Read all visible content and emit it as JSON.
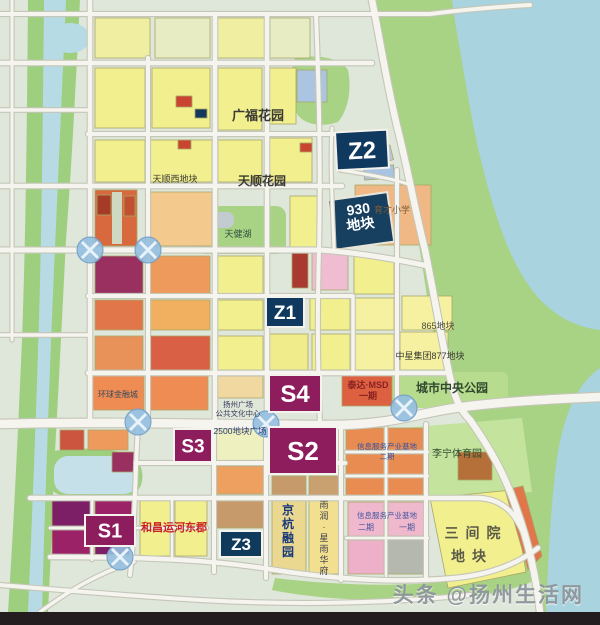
{
  "map": {
    "title": "城市地块规划图",
    "watermark": "头条 @扬州生活网",
    "colors": {
      "water": "#a9d3de",
      "river": "#b7dbe4",
      "green": "#a8d284",
      "park_light": "#c4e49e",
      "yellow_parcel": "#f2ef8f",
      "orange_parcel": "#ee9a5c",
      "red_parcel": "#d95f45",
      "pink_parcel": "#f0bcd2",
      "maroon_zone": "#8e1d5e",
      "navy_zone": "#10395f",
      "tan_parcel": "#c79a6b",
      "road": "#f6f4ee",
      "label_red": "#cc2222"
    },
    "zone_badges": [
      {
        "id": "Z2",
        "label": "Z2",
        "x": 336,
        "y": 131,
        "w": 52,
        "h": 38,
        "bg": "#10395f",
        "size": 24,
        "rotate": -3
      },
      {
        "id": "Z1",
        "label": "Z1",
        "x": 266,
        "y": 297,
        "w": 38,
        "h": 30,
        "bg": "#10395f",
        "size": 19
      },
      {
        "id": "Z3",
        "label": "Z3",
        "x": 220,
        "y": 531,
        "w": 42,
        "h": 26,
        "bg": "#0f3a5c",
        "size": 17
      },
      {
        "id": "S4",
        "label": "S4",
        "x": 269,
        "y": 375,
        "w": 52,
        "h": 37,
        "bg": "#8e1d5e",
        "size": 24
      },
      {
        "id": "S2",
        "label": "S2",
        "x": 269,
        "y": 427,
        "w": 68,
        "h": 47,
        "bg": "#8e1d5e",
        "size": 26
      },
      {
        "id": "S3",
        "label": "S3",
        "x": 174,
        "y": 429,
        "w": 38,
        "h": 33,
        "bg": "#8e1d5e",
        "size": 19
      },
      {
        "id": "S1",
        "label": "S1",
        "x": 85,
        "y": 515,
        "w": 50,
        "h": 31,
        "bg": "#8e1d5e",
        "size": 20
      }
    ],
    "region_labels": [
      {
        "text": "广福花园",
        "x": 258,
        "y": 120,
        "size": 13,
        "color": "#3a3a32",
        "weight": 700
      },
      {
        "text": "天顺西地块",
        "x": 175,
        "y": 182,
        "size": 9,
        "color": "#3a3a32"
      },
      {
        "text": "天顺花园",
        "x": 262,
        "y": 185,
        "size": 12,
        "color": "#3a3a32",
        "weight": 700
      },
      {
        "text": "天健湖",
        "x": 238,
        "y": 237,
        "size": 9,
        "color": "#2f4f3f"
      },
      {
        "text": "育才小学",
        "x": 392,
        "y": 213,
        "size": 9,
        "color": "#7a5a3a"
      },
      {
        "lines": [
          "930",
          "地块"
        ],
        "x": 359,
        "y": 214,
        "size": 14,
        "lh": 15,
        "color": "#ffffff",
        "weight": 700,
        "rotate": -8
      },
      {
        "text": "865地块",
        "x": 438,
        "y": 329,
        "size": 9,
        "color": "#4a4a3a"
      },
      {
        "text": "中星集团877地块",
        "x": 430,
        "y": 359,
        "size": 9,
        "color": "#3a3a32"
      },
      {
        "text": "城市中央公园",
        "x": 452,
        "y": 392,
        "size": 12,
        "color": "#2f4a2f",
        "weight": 700
      },
      {
        "lines": [
          "泰达·MSD",
          "一期"
        ],
        "x": 368,
        "y": 388,
        "size": 9,
        "lh": 11,
        "color": "#8a2222",
        "weight": 700
      },
      {
        "text": "李宁体育园",
        "x": 457,
        "y": 457,
        "size": 10,
        "color": "#2f4a2f"
      },
      {
        "text": "三间院",
        "x": 476,
        "y": 538,
        "size": 14,
        "color": "#5a5a48",
        "weight": 700,
        "spacing": 7
      },
      {
        "text": "地块",
        "x": 472,
        "y": 561,
        "size": 14,
        "color": "#5a5a48",
        "weight": 700,
        "spacing": 7
      },
      {
        "text": "和昌运河东郡",
        "x": 174,
        "y": 531,
        "size": 11,
        "color": "#cc2222",
        "weight": 700
      },
      {
        "text": "京杭融园",
        "x": 288,
        "y": 514,
        "size": 12,
        "color": "#1a3a7a",
        "weight": 700,
        "vertical": true
      },
      {
        "text": "雨润·星雨华府",
        "x": 324,
        "y": 508,
        "size": 9,
        "color": "#3a3a4a",
        "vertical": true
      },
      {
        "text": "信息服务产业基地",
        "x": 387,
        "y": 518,
        "size": 7.5,
        "color": "#4455a0"
      },
      {
        "text": "二期",
        "x": 366,
        "y": 530,
        "size": 8,
        "color": "#4455a0"
      },
      {
        "text": "一期",
        "x": 407,
        "y": 530,
        "size": 8,
        "color": "#4455a0"
      },
      {
        "lines": [
          "信息服务产业基地",
          "二期"
        ],
        "x": 387,
        "y": 449,
        "size": 7.5,
        "lh": 10,
        "color": "#3a50a0"
      },
      {
        "text": "环球金融城",
        "x": 118,
        "y": 397,
        "size": 8,
        "color": "#3a4a5a"
      },
      {
        "lines": [
          "扬州广场",
          "公共文化中心"
        ],
        "x": 238,
        "y": 407,
        "size": 7.5,
        "lh": 9,
        "color": "#3a3a5a"
      },
      {
        "text": "2500地块广场",
        "x": 240,
        "y": 434,
        "size": 8.5,
        "color": "#2a3a6a"
      }
    ],
    "interchanges": [
      [
        90,
        250
      ],
      [
        148,
        250
      ],
      [
        138,
        422
      ],
      [
        266,
        424
      ],
      [
        404,
        408
      ],
      [
        120,
        557
      ]
    ]
  }
}
